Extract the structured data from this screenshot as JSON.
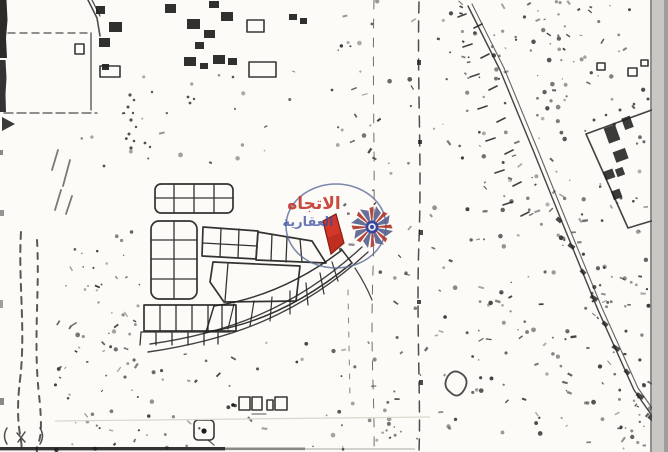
{
  "page": {
    "title": "Scanned cadastral survey map with highlighted plot"
  },
  "map": {
    "paper_color": "#f8f6f2",
    "ink_color": "#262626",
    "scan_edge_color": "#c6c4c1",
    "highlight_plot": {
      "fill": "#cf3a2b",
      "outline": "#7e1c15"
    },
    "watermark": {
      "line1": "الاتجاه",
      "line2": "العقارية",
      "line1_color": "#c03a31",
      "line2_color": "#3b4da0",
      "ring_color": "#5d6d99",
      "star_arm_color": "#5a6590",
      "star_accent_color": "#b03a31",
      "star_center_color": "#2b3c96"
    }
  }
}
